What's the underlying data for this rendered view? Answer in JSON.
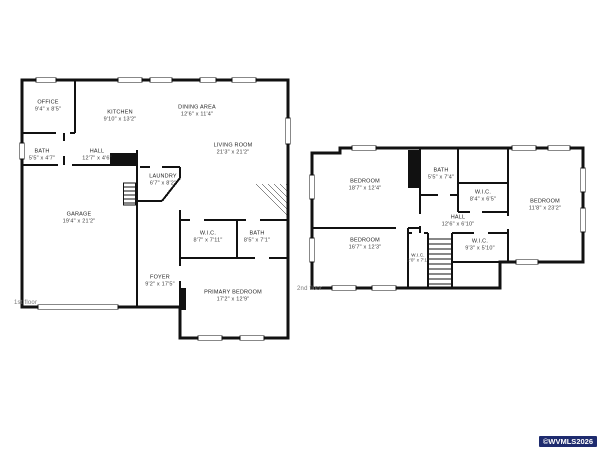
{
  "floors": [
    {
      "label": "1st floor",
      "rooms": [
        {
          "name": "OFFICE",
          "dims": "9'4\" x 8'5\""
        },
        {
          "name": "KITCHEN",
          "dims": "9'10\" x 13'2\""
        },
        {
          "name": "DINING AREA",
          "dims": "12'6\" x 11'4\""
        },
        {
          "name": "LIVING ROOM",
          "dims": "21'3\" x 21'2\""
        },
        {
          "name": "BATH",
          "dims": "5'5\" x 4'7\""
        },
        {
          "name": "HALL",
          "dims": "12'7\" x 4'6\""
        },
        {
          "name": "LAUNDRY",
          "dims": "6'7\" x 8'2\""
        },
        {
          "name": "GARAGE",
          "dims": "19'4\" x 21'2\""
        },
        {
          "name": "W.I.C.",
          "dims": "8'7\" x 7'11\""
        },
        {
          "name": "BATH",
          "dims": "8'5\" x 7'1\""
        },
        {
          "name": "FOYER",
          "dims": "9'2\" x 17'5\""
        },
        {
          "name": "PRIMARY BEDROOM",
          "dims": "17'2\" x 12'9\""
        }
      ]
    },
    {
      "label": "2nd floor",
      "rooms": [
        {
          "name": "BEDROOM",
          "dims": "18'7\" x 12'4\""
        },
        {
          "name": "BATH",
          "dims": "5'5\" x 7'4\""
        },
        {
          "name": "W.I.C.",
          "dims": "8'4\" x 6'5\""
        },
        {
          "name": "BEDROOM",
          "dims": "11'8\" x 23'2\""
        },
        {
          "name": "HALL",
          "dims": "12'6\" x 6'10\""
        },
        {
          "name": "BEDROOM",
          "dims": "16'7\" x 12'3\""
        },
        {
          "name": "W.I.C.",
          "dims": "2'0\" x 7'1\""
        },
        {
          "name": "W.I.C.",
          "dims": "9'3\" x 5'10\""
        }
      ]
    }
  ],
  "watermark": {
    "text": "©WVMLS2026"
  },
  "colors": {
    "wall": "#111111",
    "background": "#ffffff",
    "watermark_bg": "#1e2b6e",
    "watermark_text": "#ffffff",
    "label_text": "#2e2e2e"
  }
}
